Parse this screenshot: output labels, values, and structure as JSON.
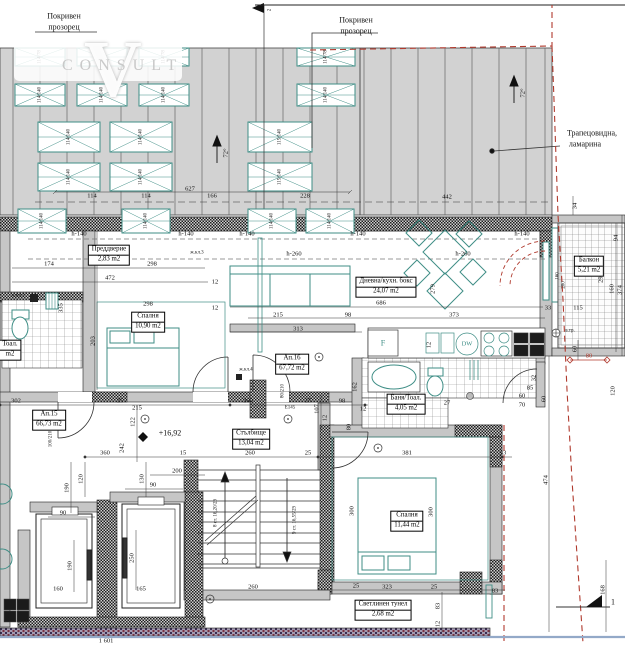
{
  "watermark": {
    "letter": "V",
    "word": "CONSULT"
  },
  "labels": {
    "roof_window_left_l1": "Покривен",
    "roof_window_left_l2": "прозорец",
    "roof_window_center_l1": "Покривен",
    "roof_window_center_l2": "прозорец",
    "sheet_metal_l1": "Трапецовидна,",
    "sheet_metal_l2": "ламарина"
  },
  "rooms": {
    "vestibule": {
      "name": "Преддверие",
      "area": "2,83 m2"
    },
    "bedroom1": {
      "name": "Спалня",
      "area": "10,90 m2"
    },
    "living": {
      "name": "Дневна/кухн. бокс",
      "area": "24,07 m2"
    },
    "ap16": {
      "name": "Ап.16",
      "area": "67,72 m2"
    },
    "ap15": {
      "name": "Ап.15",
      "area": "66,73 m2"
    },
    "stairs": {
      "name": "Стълбище",
      "area": "13,04 m2"
    },
    "bath": {
      "name": "Баня/Тоал.",
      "area": "4,05 m2"
    },
    "bedroom2": {
      "name": "Спалня",
      "area": "11,44 m2"
    },
    "balcony": {
      "name": "Балкон",
      "area": "5,21 m2"
    },
    "light_tunnel": {
      "name": "Светлинен тунел",
      "area": "2,68 m2"
    },
    "wc_left": {
      "name": "Тоал.",
      "area": "m2"
    }
  },
  "markers": {
    "elevation": "+16,92",
    "section_bottom": "1",
    "section_top": "2",
    "slope_left": "72°",
    "slope_right": "72°",
    "vent": "в.тр.",
    "fridge": "F",
    "dishwasher": "DW",
    "door_code": "Е145"
  },
  "columns": [
    "ж.кл.2",
    "ж.кл.3",
    "ж.кл.4"
  ],
  "heights": {
    "h140": "h-140",
    "h260": "h-260"
  },
  "stairs_text": {
    "up": "8 ст. 16,20/29",
    "down": "9 ст. 16,55/29"
  },
  "door_sizes": {
    "d80": "80/210",
    "d100": "100/210"
  },
  "window_sizes": {
    "small": "114/78",
    "standard": "114/140",
    "alt": "115/140"
  },
  "dims": [
    "627",
    "114",
    "114",
    "166",
    "228",
    "442",
    "34",
    "94",
    "160",
    "374",
    "290",
    "115",
    "33",
    "174",
    "298",
    "472",
    "131",
    "12",
    "12",
    "298",
    "335",
    "203",
    "215",
    "98",
    "313",
    "686",
    "373",
    "279",
    "302",
    "25",
    "215",
    "122",
    "242",
    "360",
    "260",
    "25",
    "98",
    "107",
    "12",
    "27",
    "162",
    "12",
    "120",
    "60",
    "80",
    "32",
    "85",
    "60",
    "70",
    "60",
    "15",
    "260",
    "25",
    "381",
    "33",
    "300",
    "300",
    "90",
    "90",
    "200",
    "130",
    "120",
    "190",
    "190",
    "250",
    "160",
    "165",
    "1 601",
    "260",
    "323",
    "25",
    "25",
    "83",
    "83",
    "12",
    "474",
    "168",
    "12",
    "80",
    "160",
    "280"
  ]
}
